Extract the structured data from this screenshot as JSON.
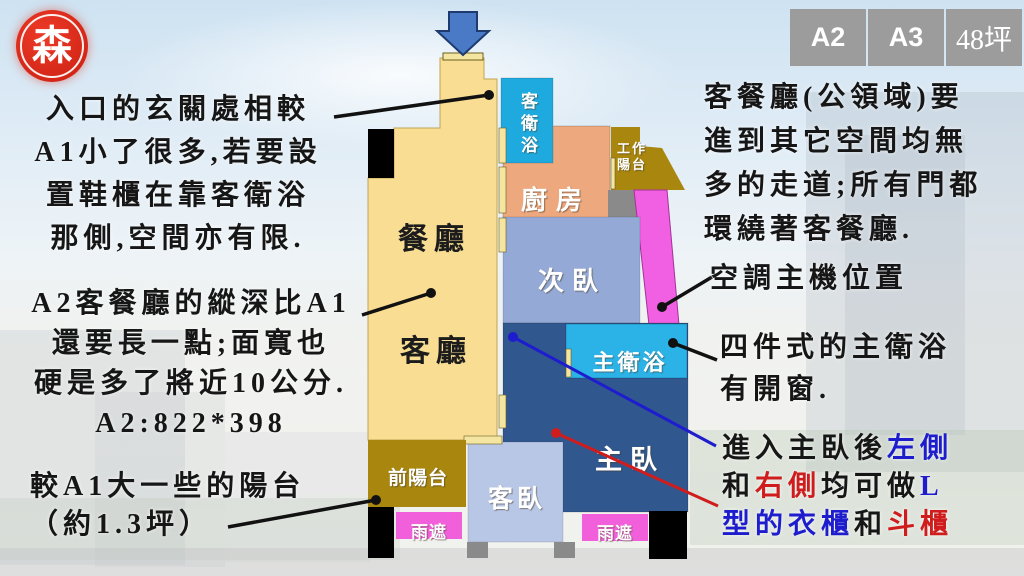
{
  "logo": {
    "char": "森"
  },
  "tabs": [
    {
      "label": "A2"
    },
    {
      "label": "A3"
    },
    {
      "label": "48坪"
    }
  ],
  "plan": {
    "rooms": {
      "dining": "餐廳",
      "living": "客廳",
      "guest_bath": "客衛浴",
      "kitchen": "廚房",
      "work_balcony": "工作陽台",
      "second_bedroom": "次臥",
      "master_bath": "主衛浴",
      "master_bedroom": "主臥",
      "guest_bedroom": "客臥",
      "front_balcony": "前陽台",
      "rain_cover_left": "雨遮",
      "rain_cover_right": "雨遮"
    }
  },
  "annotations": {
    "entry": {
      "lines": [
        "入口的玄關處相較",
        "A1小了很多,若要設",
        "置鞋櫃在靠客衛浴",
        "那側,空間亦有限."
      ]
    },
    "living_depth": {
      "lines": [
        "A2客餐廳的縱深比A1",
        "還要長一點;面寬也",
        "硬是多了將近10公分.",
        "A2:822*398"
      ]
    },
    "balcony": {
      "lines": [
        "較A1大一些的陽台",
        "（約1.3坪）"
      ]
    },
    "public_area": {
      "lines": [
        "客餐廳(公領域)要",
        "進到其它空間均無",
        "多的走道;所有門都",
        "環繞著客餐廳."
      ]
    },
    "ac": {
      "text": "空調主機位置"
    },
    "master_bath_note": {
      "lines": [
        "四件式的主衛浴",
        "有開窗."
      ]
    },
    "wardrobe": {
      "line1": [
        {
          "t": "進入主臥後"
        },
        {
          "t": "左側"
        }
      ],
      "line2": [
        {
          "t": "和"
        },
        {
          "t": "右側"
        },
        {
          "t": "均可做"
        },
        {
          "t": "L"
        }
      ],
      "line3": [
        {
          "t": "型的衣櫃"
        },
        {
          "t": "和"
        },
        {
          "t": "斗櫃"
        }
      ]
    }
  },
  "colors": {
    "dining_yellow": "#F8DD92",
    "bath_cyan": "#1FAADF",
    "kitchen_salmon": "#EEA87E",
    "balcony_gold": "#A9860E",
    "second_bed_blue": "#94A9D5",
    "guest_bed_blue": "#B9C7E6",
    "master_bed_blue": "#31578F",
    "ac_magenta": "#F15FE2",
    "rain_cover_magenta": "#F160DA",
    "door_tan": "#F4E6A0",
    "tab_gray": "#9C9C9C",
    "seal_red": "#D8291A",
    "callout_blue": "#1D1DCE",
    "callout_red": "#CF1D1D",
    "entrance_arrow_blue": "#4A7AC5"
  }
}
